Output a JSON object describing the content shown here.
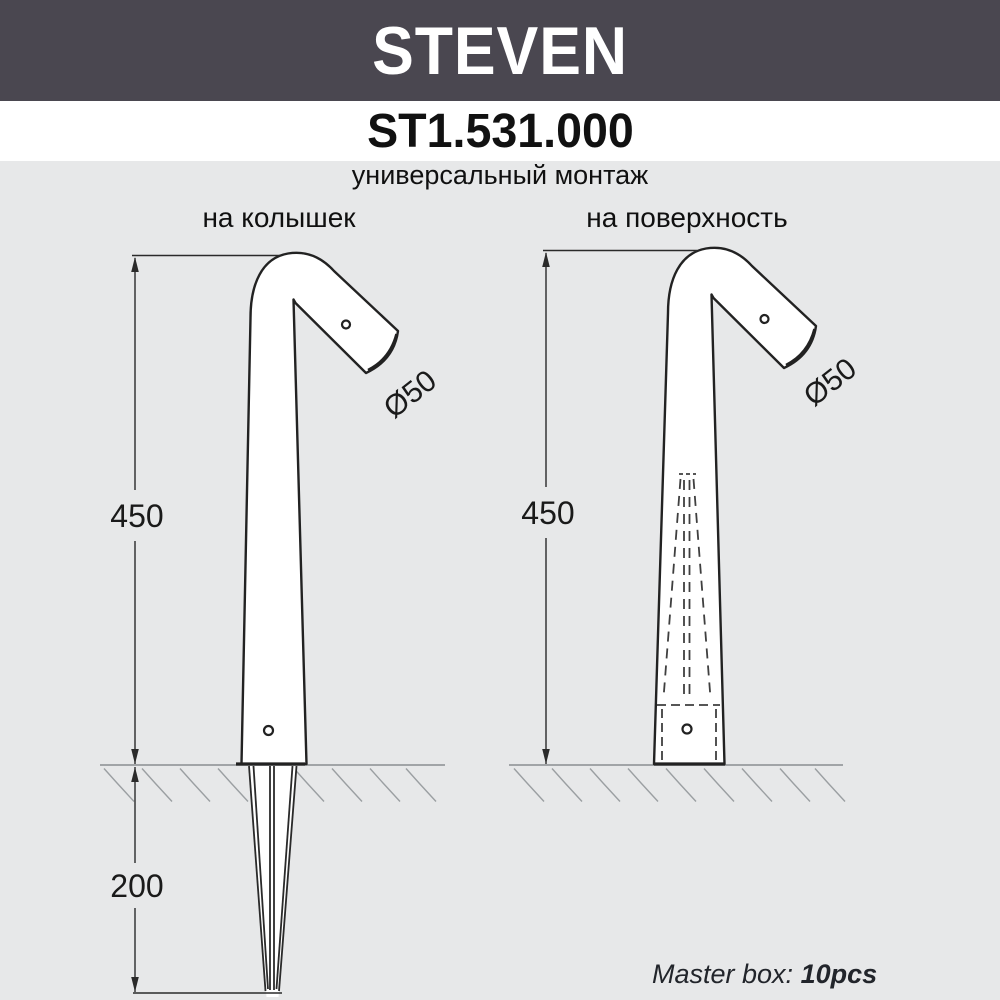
{
  "banner": {
    "title": "STEVEN",
    "bg_color": "#4a4750",
    "text_color": "#ffffff"
  },
  "model": {
    "code": "ST1.531.000"
  },
  "subtitle": "универсальный монтаж",
  "columns": {
    "left_label": "на колышек",
    "right_label": "на поверхность"
  },
  "drawings": {
    "left": {
      "height_mm": "450",
      "spike_depth_mm": "200",
      "head_diameter": "Ø50"
    },
    "right": {
      "height_mm": "450",
      "head_diameter": "Ø50"
    }
  },
  "footer": {
    "master_box_label": "Master box:",
    "master_box_value": "10pcs"
  },
  "colors": {
    "background": "#e7e8e9",
    "banner": "#4a4750",
    "drawing_line": "#222222",
    "ground_line": "#8a8e91",
    "hatch_line": "#9b9fa2"
  }
}
